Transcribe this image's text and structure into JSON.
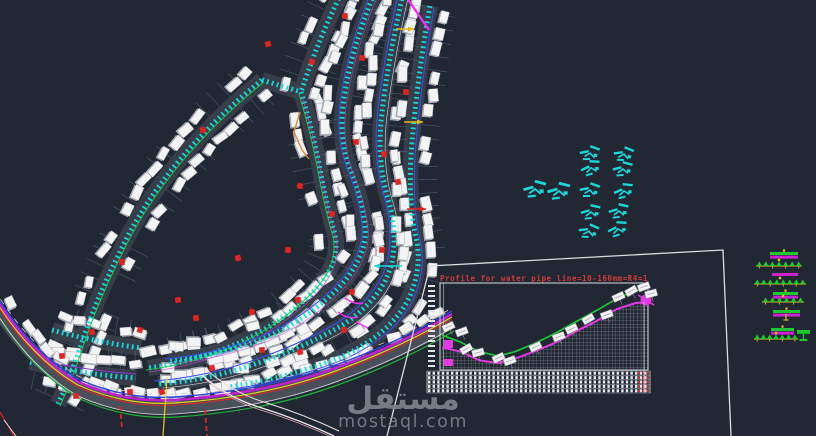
{
  "app": {
    "type": "cad-site-drawing",
    "background": "#222734"
  },
  "watermark": {
    "name_ar": "مستقل",
    "domain": "mostaql.com",
    "color": "#80858f"
  },
  "profile": {
    "title": "Profile for water pipe line=10-160mm=R4=1",
    "title_color": "#cf3a3a",
    "frame_pts": "M 387,436 L 430,266 L 723,250 L 731,436",
    "plot": {
      "x": 440,
      "y": 283,
      "w": 208,
      "h": 87
    },
    "axis_tick_count": 17,
    "table": {
      "x": 427,
      "y": 371,
      "w": 223,
      "rows": 5
    },
    "label_boxes": [
      [
        450,
        330,
        -25
      ],
      [
        463,
        335,
        -20
      ],
      [
        468,
        352,
        -30
      ],
      [
        479,
        356,
        -15
      ],
      [
        500,
        361,
        -25
      ],
      [
        511,
        364,
        -20
      ],
      [
        537,
        350,
        -25
      ],
      [
        560,
        340,
        -20
      ],
      [
        573,
        332,
        -25
      ],
      [
        590,
        322,
        -30
      ],
      [
        608,
        318,
        -20
      ],
      [
        620,
        300,
        -25
      ],
      [
        633,
        294,
        -30
      ],
      [
        645,
        290,
        -20
      ],
      [
        652,
        297,
        -15
      ]
    ]
  },
  "chart_data": {
    "type": "line",
    "title": "Profile for water pipe line=10-160mm=R4=1",
    "xlabel": "station (relative 0-1, tick labels illegible)",
    "ylabel": "elevation (relative 0-1, tick labels illegible)",
    "grid": "hatch-below-curve",
    "legend_position": "none",
    "y_range": [
      0,
      1
    ],
    "series": [
      {
        "name": "ground-level",
        "color": "#1dc937",
        "x": [
          0.01,
          0.1,
          0.19,
          0.28,
          0.36,
          0.46,
          0.56,
          0.65,
          0.75,
          0.85,
          0.94,
          1.0
        ],
        "y": [
          0.4,
          0.32,
          0.21,
          0.16,
          0.21,
          0.31,
          0.43,
          0.55,
          0.68,
          0.82,
          0.91,
          0.94
        ]
      },
      {
        "name": "pipe-invert",
        "color": "#e23ae2",
        "x": [
          0.01,
          0.1,
          0.19,
          0.28,
          0.36,
          0.46,
          0.56,
          0.65,
          0.75,
          0.85,
          0.94,
          1.0
        ],
        "y": [
          0.26,
          0.21,
          0.11,
          0.08,
          0.13,
          0.22,
          0.32,
          0.44,
          0.56,
          0.7,
          0.77,
          0.78
        ]
      }
    ]
  },
  "drawing": {
    "pipe_color": "#12dfdf",
    "street_bed_color": "#3a414c",
    "comb_color": "#5a6170",
    "building_fill": "#f4f4f4",
    "building_shadow": "#a8adb5",
    "red_marker_color": "#e32222",
    "streets": [
      {
        "d": "M 262,80 Q 215,118 178,162 Q 140,208 118,256 Q 96,300 82,342 Q 70,378 58,404",
        "pipe": true,
        "buildings": "both",
        "comb": true,
        "companions": [
          {
            "color": "#22c443",
            "dx": 2,
            "dy": 2,
            "w": 0.9
          }
        ]
      },
      {
        "d": "M 262,80 L 301,92",
        "pipe": true,
        "buildings": "none",
        "comb": false,
        "companions": []
      },
      {
        "d": "M 301,92 Q 314,135 321,175 Q 329,215 334,231 Q 343,262 313,292 Q 283,322 239,343 Q 195,362 148,368",
        "pipe": true,
        "buildings": "both",
        "comb": true,
        "companions": [
          {
            "color": "#22c443",
            "dx": -2,
            "dy": 2,
            "w": 0.9
          },
          {
            "color": "#c24ad4",
            "dx": 1,
            "dy": 4,
            "w": 0.8,
            "o": 0.75
          }
        ]
      },
      {
        "d": "M 341,-6 Q 318,40 301,92",
        "pipe": true,
        "buildings": "both",
        "comb": true,
        "companions": []
      },
      {
        "d": "M 374,-6 Q 352,48 345,92 Q 337,136 350,170 Q 362,198 365,226 Q 368,254 342,284 Q 311,318 265,338 Q 219,356 168,361",
        "pipe": true,
        "buildings": "both",
        "comb": true,
        "companions": [
          {
            "color": "#3b50f0",
            "dx": -3,
            "dy": -2,
            "w": 1
          },
          {
            "color": "#c24ad4",
            "dx": 3,
            "dy": 3,
            "w": 0.7,
            "o": 0.7
          }
        ]
      },
      {
        "d": "M 403,-6 Q 388,60 382,112 Q 376,162 389,202 Q 398,236 391,266 Q 381,300 341,326 Q 299,350 249,366 Q 207,380 158,384",
        "pipe": true,
        "buildings": "both",
        "comb": true,
        "companions": [
          {
            "color": "#3b50f0",
            "dx": -4,
            "dy": -3,
            "w": 1.1
          },
          {
            "color": "#cfd3da",
            "dx": 5,
            "dy": 4,
            "w": 0.6
          }
        ]
      },
      {
        "d": "M 430,6 Q 417,80 412,142 Q 407,202 417,242 Q 422,272 407,302 Q 387,336 341,357 Q 289,378 229,387",
        "pipe": true,
        "buildings": "both",
        "comb": true,
        "companions": [
          {
            "color": "#3b50f0",
            "dx": 4,
            "dy": 2,
            "w": 1
          }
        ]
      },
      {
        "d": "M 52,330 Q 96,342 141,348",
        "pipe": true,
        "buildings": "both",
        "comb": true,
        "companions": []
      },
      {
        "d": "M 30,362 Q 80,374 136,378",
        "pipe": true,
        "buildings": "both",
        "comb": true,
        "companions": [
          {
            "color": "#8a3ad4",
            "dx": 0,
            "dy": -4,
            "w": 0.9
          }
        ]
      }
    ],
    "road": {
      "d": "M -6,303 Q 30,362 78,390 Q 125,411 175,408 Q 262,402 330,378 Q 398,354 452,322",
      "bed_color": "#4a505a",
      "bed_width": 13,
      "buildings": "up",
      "lines": [
        {
          "dx": 2,
          "dy": 9,
          "color": "#1fb43a",
          "w": 1.2
        },
        {
          "dx": 0,
          "dy": 6,
          "color": "#d8dadd",
          "w": 0.8
        },
        {
          "dx": 0,
          "dy": -3,
          "color": "#dd2424",
          "w": 1.0
        },
        {
          "dx": 0,
          "dy": -5,
          "color": "#e6cf22",
          "w": 1.2
        },
        {
          "dx": 0,
          "dy": -8,
          "color": "#bd22cf",
          "w": 2.6
        },
        {
          "dx": 0,
          "dy": -11,
          "color": "#2d43de",
          "w": 1.4
        },
        {
          "dx": 0,
          "dy": -14,
          "color": "#c9ccd2",
          "w": 0.8,
          "dash": "6 6"
        }
      ]
    },
    "branch_road": {
      "d": "M 203,376 Q 228,398 262,408 Q 300,420 334,436",
      "lines": [
        {
          "dx": 0,
          "dy": 0,
          "color": "#efeaea",
          "w": 1.3
        },
        {
          "dx": 5,
          "dy": -5,
          "color": "#e8e2e0",
          "w": 1.0
        },
        {
          "dx": 2,
          "dy": 3,
          "color": "#e8a8b8",
          "w": 0.7
        }
      ]
    },
    "verticals": [
      {
        "x1": 167,
        "y1": 378,
        "x2": 163,
        "y2": 436,
        "color": "#e6cf22",
        "w": 1.2
      },
      {
        "x1": 120,
        "y1": 406,
        "x2": 122,
        "y2": 428,
        "color": "#dd2424",
        "w": 1.8,
        "dash": "5 3"
      },
      {
        "x1": 205,
        "y1": 410,
        "x2": 207,
        "y2": 436,
        "color": "#dd2424",
        "w": 1.8,
        "dash": "5 3"
      },
      {
        "x1": 0,
        "y1": 412,
        "x2": 14,
        "y2": 436,
        "color": "#dd2424",
        "w": 1.2
      },
      {
        "x1": 4,
        "y1": 420,
        "x2": 16,
        "y2": 436,
        "color": "#d8dadd",
        "w": 1.0
      }
    ],
    "orange_path": {
      "d": "M 300,112 L 294,132 L 302,150 L 309,159",
      "color": "#e08a2e",
      "w": 1.4
    },
    "magenta_color": "#f32ef3",
    "magenta_accents": [
      {
        "d": "M 407,-2 L 429,30",
        "w": 2.4
      },
      {
        "d": "M 345,298 q 9,7 18,5",
        "w": 1.6
      },
      {
        "d": "M 338,312 q 10,8 20,5",
        "w": 1.4
      },
      {
        "d": "M 356,322 l 12,6",
        "w": 1.4
      }
    ],
    "arrows": [
      {
        "x1": 396,
        "y1": 29,
        "x2": 414,
        "y2": 29,
        "color": "#e3b51e"
      },
      {
        "x1": 404,
        "y1": 122,
        "x2": 423,
        "y2": 122,
        "color": "#e3b51e"
      },
      {
        "x1": 407,
        "y1": 209,
        "x2": 426,
        "y2": 209,
        "color": "#e02222"
      },
      {
        "x1": 402,
        "y1": 266,
        "x2": 374,
        "y2": 266,
        "color": "#18d8d8"
      }
    ],
    "red_markers": [
      [
        345,
        16
      ],
      [
        312,
        62
      ],
      [
        268,
        44
      ],
      [
        203,
        130
      ],
      [
        356,
        142
      ],
      [
        300,
        186
      ],
      [
        332,
        214
      ],
      [
        384,
        154
      ],
      [
        406,
        92
      ],
      [
        238,
        258
      ],
      [
        178,
        300
      ],
      [
        122,
        262
      ],
      [
        92,
        332
      ],
      [
        62,
        356
      ],
      [
        140,
        330
      ],
      [
        196,
        318
      ],
      [
        252,
        312
      ],
      [
        298,
        300
      ],
      [
        352,
        292
      ],
      [
        262,
        350
      ],
      [
        212,
        368
      ],
      [
        162,
        392
      ],
      [
        300,
        352
      ],
      [
        344,
        330
      ],
      [
        382,
        250
      ],
      [
        398,
        182
      ],
      [
        362,
        58
      ],
      [
        130,
        392
      ],
      [
        76,
        396
      ],
      [
        288,
        250
      ]
    ],
    "symbol_color": "#19d8d8",
    "symbol_positions": [
      [
        534,
        189
      ],
      [
        558,
        191
      ],
      [
        589,
        153
      ],
      [
        590,
        168
      ],
      [
        589,
        190
      ],
      [
        590,
        212
      ],
      [
        588,
        231
      ],
      [
        623,
        154
      ],
      [
        622,
        169
      ],
      [
        623,
        191
      ],
      [
        618,
        211
      ],
      [
        617,
        229
      ]
    ]
  },
  "legend": {
    "colors": {
      "green": "#1cc92e",
      "magenta": "#cf22cf",
      "yellow": "#e0c11f"
    },
    "shapes": [
      {
        "t": "bar2",
        "x": 770,
        "y": 252,
        "w": 28
      },
      {
        "t": "row",
        "x": 756,
        "y": 266,
        "w": 46,
        "n": 7
      },
      {
        "t": "mbar",
        "x": 772,
        "y": 273,
        "w": 26
      },
      {
        "t": "row",
        "x": 754,
        "y": 284,
        "w": 52,
        "n": 8
      },
      {
        "t": "bar2",
        "x": 773,
        "y": 292,
        "w": 25
      },
      {
        "t": "row",
        "x": 762,
        "y": 302,
        "w": 42,
        "n": 6
      },
      {
        "t": "bar2",
        "x": 773,
        "y": 310,
        "w": 27
      },
      {
        "t": "stem",
        "x": 786,
        "y": 314
      },
      {
        "t": "bar2",
        "x": 771,
        "y": 328,
        "w": 23
      },
      {
        "t": "row",
        "x": 754,
        "y": 339,
        "w": 44,
        "n": 7
      },
      {
        "t": "gblock",
        "x": 797,
        "y": 330,
        "w": 13
      }
    ]
  }
}
